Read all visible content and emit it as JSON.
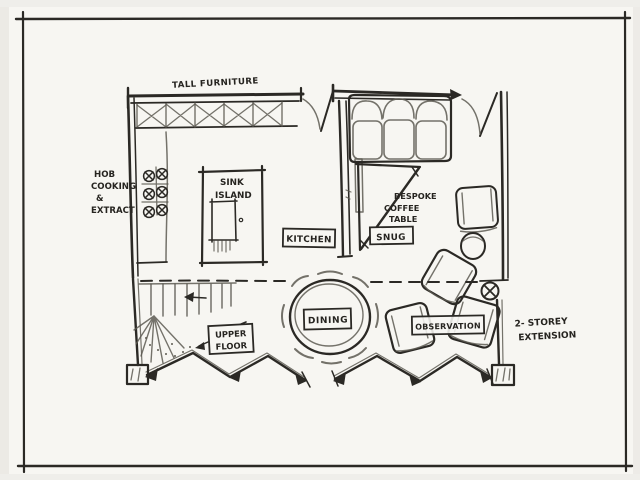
{
  "drawing": {
    "type": "hand-drawn single-storey extension floor plan sketch",
    "colors": {
      "paper": "#f7f6f2",
      "ink": "#2b2925",
      "pencil": "#5d5a52"
    }
  },
  "labels": {
    "tall_furniture": "TALL FURNITURE",
    "hob_extract": [
      "HOB",
      "COOKING",
      "&",
      "EXTRACT"
    ],
    "sink_island": [
      "SINK",
      "ISLAND"
    ],
    "kitchen": "KITCHEN",
    "snug": "SNUG",
    "bespoke_coffee_table": [
      "BESPOKE",
      "COFFEE",
      "TABLE"
    ],
    "dining": "DINING",
    "upper_floor": [
      "UPPER",
      "FLOOR"
    ],
    "observation": "OBSERVATION",
    "two_storey_extension": [
      "2- STOREY",
      "EXTENSION"
    ]
  }
}
